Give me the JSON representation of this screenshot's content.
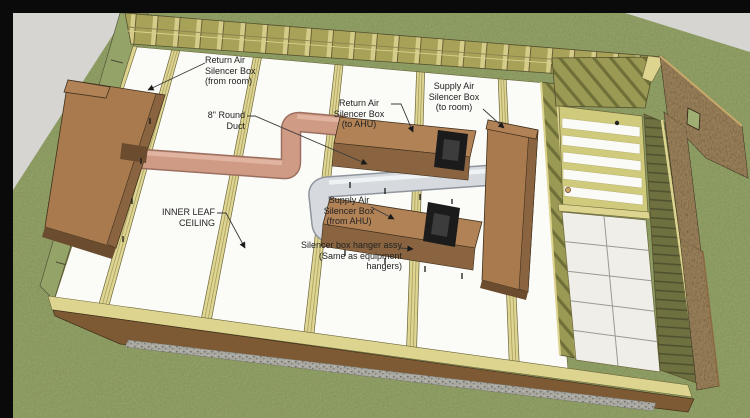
{
  "annotations": {
    "return_from_room": {
      "text": "Return Air\nSilencer Box\n(from room)"
    },
    "round_duct": {
      "text": "8\" Round\nDuct"
    },
    "return_to_ahu": {
      "text": "Return Air\nSilencer Box\n(to AHU)"
    },
    "supply_to_room": {
      "text": "Supply Air\nSilencer Box\n(to room)"
    },
    "supply_from_ahu": {
      "text": "Supply Air\nSilencer Box\n(from AHU)"
    },
    "hanger_assy": {
      "text": "Silencer box hanger assy\n(Same as equipment\nhangers)"
    },
    "inner_leaf_ceiling": {
      "text": "INNER LEAF\nCEILING"
    }
  },
  "colors": {
    "letterbox": "#0a0a0a",
    "grass": "#a0ae74",
    "grass_band": "#94a368",
    "ground": "#d6d5d2",
    "ceiling_panel": "#fbfbf8",
    "joist": "#ded593",
    "plate_yellow": "#ddd48f",
    "stud_band": "#a7a258",
    "stud_light": "#d5cc8a",
    "box_brown": "#a87a4e",
    "box_brown_light": "#b28257",
    "box_brown_dark": "#8a6440",
    "box_end_dark": "#6b4c2e",
    "duct_pink": "#cf9b84",
    "duct_pink_dark": "#9c7060",
    "duct_pink_light": "#e0b4a0",
    "duct_white": "#d6dade",
    "duct_white_dark": "#8f959d",
    "duct_white_light": "#eef2f4",
    "ahu_black": "#1b1b1b",
    "osb": "#5d4527",
    "osb_edge": "#c9a96b",
    "olive_wall": "#9a9a55",
    "olive_dark": "#6e7040",
    "tile_floor": "#efeee8",
    "gravel": "#a9a8a1",
    "label_text": "#222222"
  }
}
